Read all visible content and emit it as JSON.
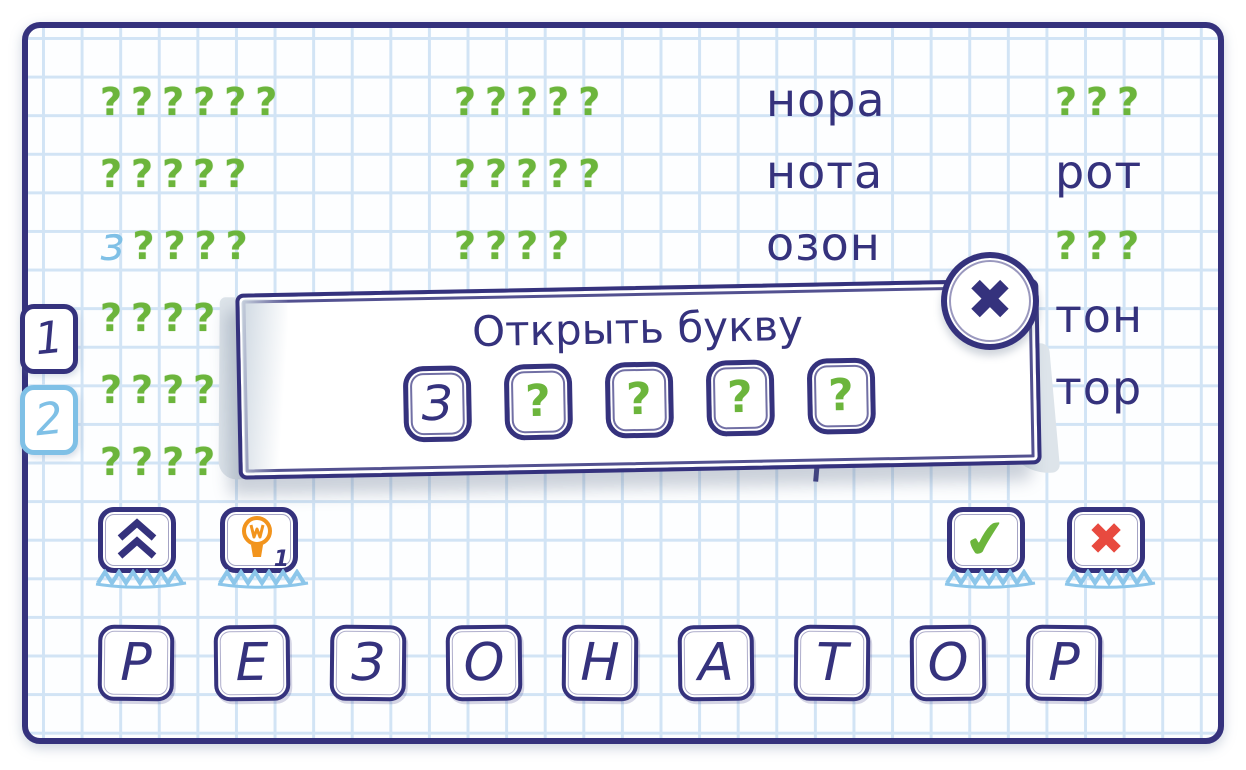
{
  "colors": {
    "ink": "#35327d",
    "green": "#6cb53c",
    "sky": "#7fc0e6",
    "grid_line": "#d2e4f5",
    "paper": "#fdfeff",
    "orange": "#f2941d",
    "red": "#e84a3f",
    "curl_shadow": "#dde4ea"
  },
  "board": {
    "question_glyph": "?",
    "columns": [
      {
        "rows": [
          {
            "mask": 6
          },
          {
            "mask": 5
          },
          {
            "mask": 4,
            "prefix": "з"
          },
          {
            "mask": 5
          },
          {
            "mask": 5
          },
          {
            "mask": 5
          }
        ]
      },
      {
        "rows": [
          {
            "mask": 5
          },
          {
            "mask": 5
          },
          {
            "mask": 4
          }
        ]
      },
      {
        "rows": [
          {
            "word": "нора"
          },
          {
            "word": "нота"
          },
          {
            "word": "озон"
          }
        ]
      },
      {
        "rows": [
          {
            "mask": 3
          },
          {
            "word": "рот"
          },
          {
            "mask": 3
          },
          {
            "word": "тон"
          },
          {
            "word": "тор"
          }
        ]
      }
    ]
  },
  "page_tabs": [
    {
      "label": "1",
      "active": true
    },
    {
      "label": "2",
      "active": false
    }
  ],
  "dialog": {
    "title": "Открыть букву",
    "slots": [
      "З",
      "?",
      "?",
      "?",
      "?"
    ],
    "close_glyph": "✖"
  },
  "toolbar": {
    "hint_badge": "1",
    "confirm_glyph": "✔",
    "cancel_glyph": "✖"
  },
  "letter_tiles": [
    "Р",
    "Е",
    "З",
    "О",
    "Н",
    "А",
    "Т",
    "О",
    "Р"
  ]
}
